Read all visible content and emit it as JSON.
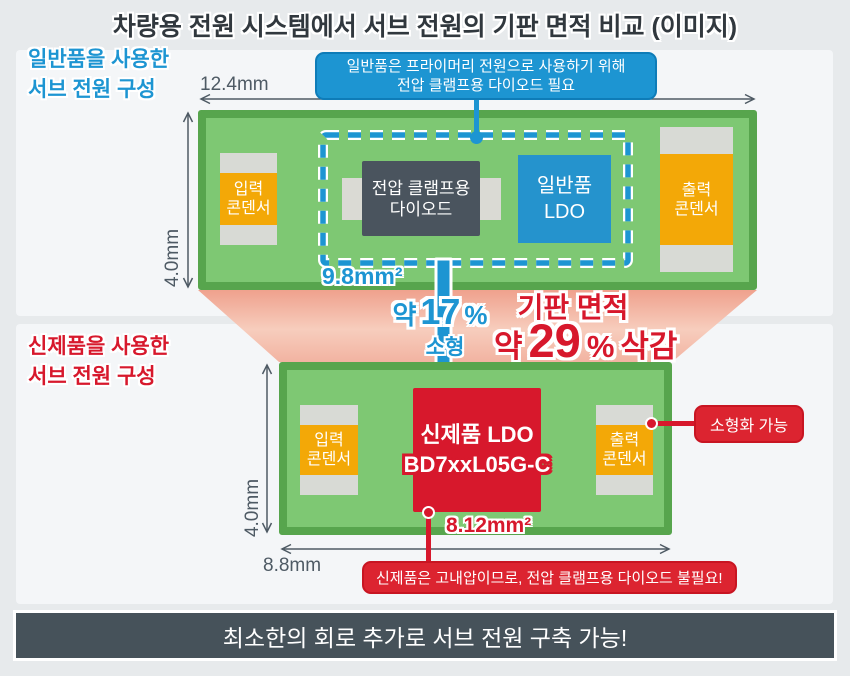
{
  "title": "차량용 전원 시스템에서 서브 전원의 기판 면적 비교 (이미지)",
  "top_section": {
    "label": {
      "line1": "일반품을 사용한",
      "line2": "서브 전원 구성"
    },
    "callout": {
      "line1": "일반품은 프라이머리 전원으로 사용하기 위해",
      "line2": "전압 클램프용 다이오드 필요"
    },
    "board": {
      "width_label": "12.4mm",
      "height_label": "4.0mm",
      "clamp_area_label": "9.8mm²",
      "input_capacitor": {
        "line1": "입력",
        "line2": "콘덴서"
      },
      "diode": {
        "line1": "전압 클램프용",
        "line2": "다이오드"
      },
      "ldo": {
        "line1": "일반품",
        "line2": "LDO"
      },
      "output_capacitor": {
        "line1": "출력",
        "line2": "콘덴서"
      }
    }
  },
  "comparison": {
    "size_reduction": {
      "approx": "약",
      "value": "17",
      "percent": "%",
      "caption": "소형"
    },
    "area_reduction": {
      "heading": "기판 면적",
      "approx": "약",
      "value": "29",
      "percent": "%",
      "suffix": "삭감"
    }
  },
  "bottom_section": {
    "label": {
      "line1": "신제품을 사용한",
      "line2": "서브 전원 구성"
    },
    "board": {
      "width_label": "8.8mm",
      "height_label": "4.0mm",
      "ldo_area_label": "8.12mm²",
      "input_capacitor": {
        "line1": "입력",
        "line2": "콘덴서"
      },
      "ldo": {
        "line1": "신제품 LDO",
        "line2": "BD7xxL05G-C"
      },
      "output_capacitor": {
        "line1": "출력",
        "line2": "콘덴서"
      }
    },
    "callout_right": "소형화 가능",
    "callout_bottom": "신제품은 고내압이므로, 전압 클램프용 다이오드 불필요!"
  },
  "footer": "최소한의 회로 추가로 서브 전원 구축 가능!",
  "colors": {
    "blue": "#1d95d2",
    "red": "#d7182c",
    "green_fill": "#7ec873",
    "green_border": "#57a54d",
    "orange": "#f3a807",
    "diode_gray": "#4a545e",
    "footer_bar": "#46525a",
    "pink_funnel": "#f0a58f",
    "panel": "#f4f6f8",
    "background": "#e7eaec"
  }
}
